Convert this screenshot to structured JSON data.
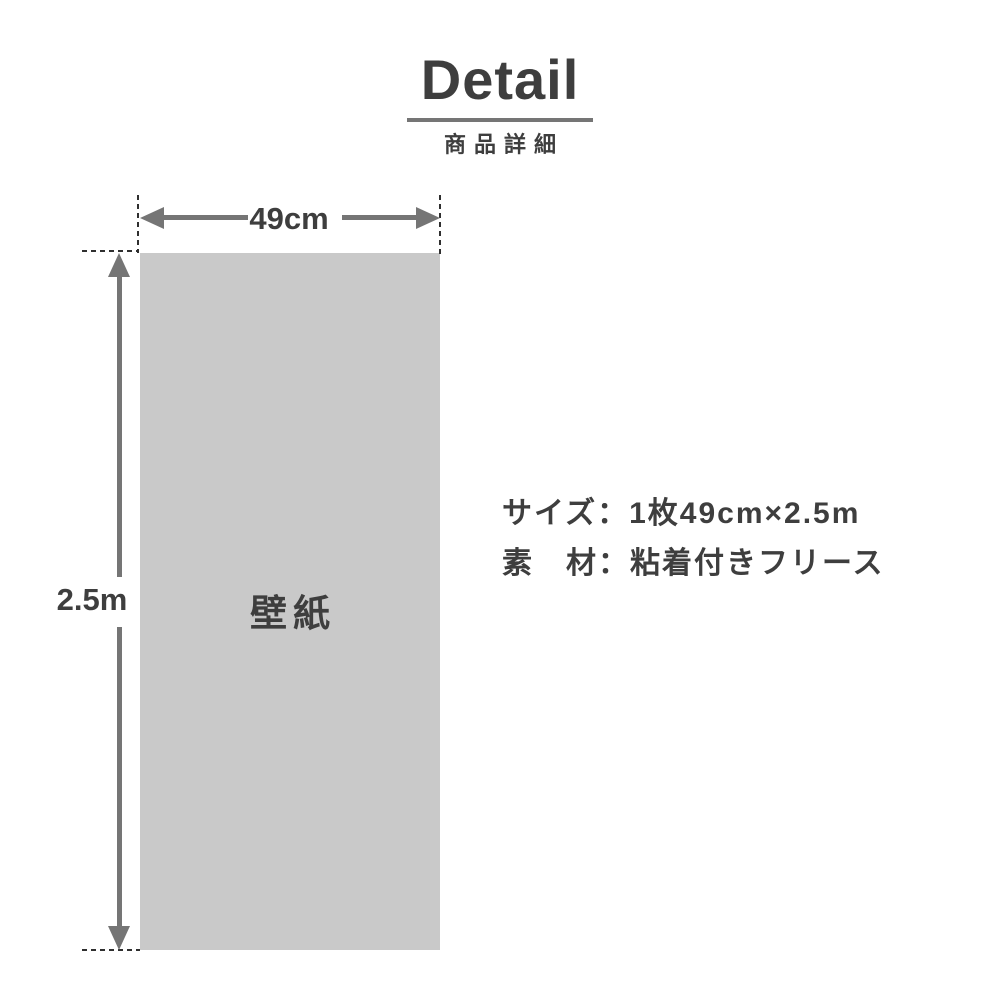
{
  "header": {
    "title": "Detail",
    "subtitle": "商品詳細"
  },
  "diagram": {
    "panel_label": "壁紙",
    "width_label": "49cm",
    "height_label": "2.5m"
  },
  "specs": {
    "size": "サイズ：1枚49cm×2.5m",
    "material": "素　材：粘着付きフリース"
  },
  "colors": {
    "text": "#3e3e3e",
    "measure": "#757575",
    "panel_fill": "#c9c9c9",
    "dash": "#2f2f2f",
    "background": "#ffffff"
  }
}
